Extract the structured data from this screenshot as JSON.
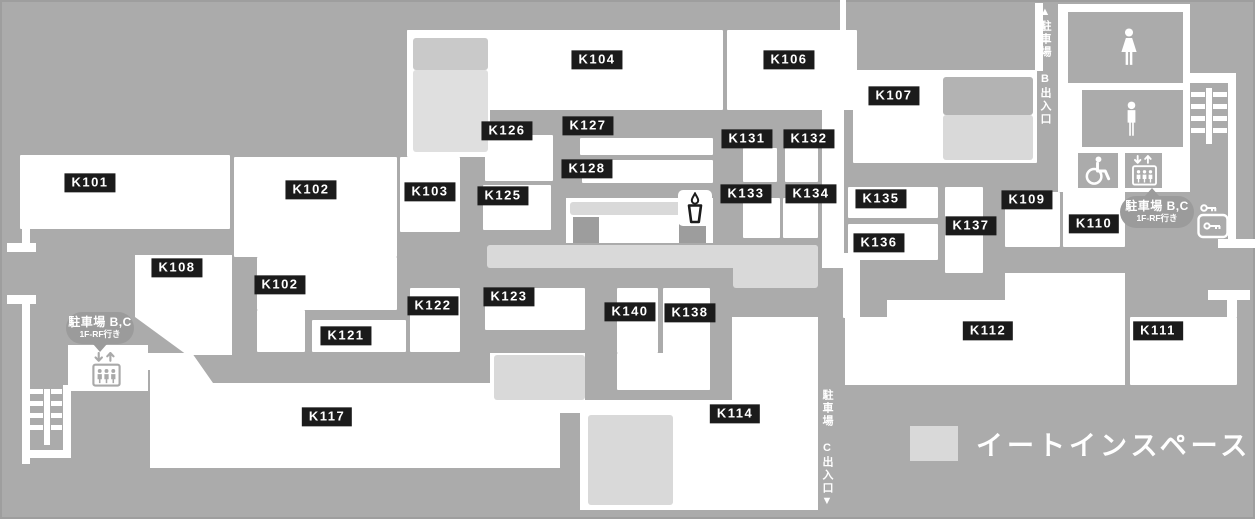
{
  "map": {
    "colors": {
      "background": "#ababab",
      "unit": "#ffffff",
      "eat_in": "#d9d9d9",
      "kiosk": "#9d9d9d",
      "label_bg": "#1b1b1b",
      "label_text": "#ffffff",
      "badge_bg": "#9b9b9b"
    },
    "legend": {
      "label": "イートインスペース",
      "swatch_color": "#d9d9d9"
    },
    "corridor_b": {
      "text": "▲駐車場 B出入口"
    },
    "corridor_c": {
      "text": "駐車場 C出入口▼"
    },
    "badges": {
      "left": {
        "line1": "駐車場 B,C",
        "line2": "1F-RF行き"
      },
      "right": {
        "line1": "駐車場 B,C",
        "line2": "1F-RF行き"
      }
    },
    "rooms": [
      {
        "id": "K101",
        "label": "K101",
        "label_cx": 90,
        "label_cy": 183,
        "rects": [
          [
            20,
            155,
            210,
            74
          ]
        ]
      },
      {
        "id": "K102",
        "label": "K102",
        "label_cx": 311,
        "label_cy": 190,
        "rects": [
          [
            234,
            157,
            163,
            100
          ]
        ]
      },
      {
        "id": "K102b",
        "label": "K102",
        "label_cx": 280,
        "label_cy": 285,
        "rects": [
          [
            257,
            257,
            140,
            53
          ],
          [
            257,
            310,
            48,
            42
          ]
        ]
      },
      {
        "id": "K103",
        "label": "K103",
        "label_cx": 430,
        "label_cy": 192,
        "rects": [
          [
            400,
            157,
            60,
            75
          ]
        ]
      },
      {
        "id": "K104",
        "label": "K104",
        "label_cx": 597,
        "label_cy": 60,
        "rects": [
          [
            407,
            30,
            316,
            80
          ],
          [
            407,
            30,
            83,
            127
          ]
        ]
      },
      {
        "id": "K106",
        "label": "K106",
        "label_cx": 789,
        "label_cy": 60,
        "rects": [
          [
            727,
            30,
            130,
            80
          ]
        ]
      },
      {
        "id": "K107",
        "label": "K107",
        "label_cx": 894,
        "label_cy": 96,
        "rects": [
          [
            853,
            70,
            184,
            93
          ]
        ]
      },
      {
        "id": "K108",
        "label": "K108",
        "label_cx": 177,
        "label_cy": 268,
        "polygon": [
          [
            135,
            255
          ],
          [
            232,
            255
          ],
          [
            232,
            355
          ],
          [
            187,
            355
          ],
          [
            135,
            317
          ]
        ]
      },
      {
        "id": "K109",
        "label": "K109",
        "label_cx": 1027,
        "label_cy": 200,
        "rects": [
          [
            1005,
            192,
            55,
            55
          ]
        ]
      },
      {
        "id": "K110",
        "label": "K110",
        "label_cx": 1094,
        "label_cy": 224,
        "rects": [
          [
            1063,
            190,
            62,
            57
          ]
        ]
      },
      {
        "id": "K111",
        "label": "K111",
        "label_cx": 1158,
        "label_cy": 331,
        "rects": [
          [
            1130,
            317,
            107,
            68
          ]
        ]
      },
      {
        "id": "K112",
        "label": "K112",
        "label_cx": 988,
        "label_cy": 331,
        "polygon": [
          [
            845,
            317
          ],
          [
            887,
            317
          ],
          [
            887,
            300
          ],
          [
            1005,
            300
          ],
          [
            1005,
            273
          ],
          [
            1125,
            273
          ],
          [
            1125,
            385
          ],
          [
            845,
            385
          ]
        ]
      },
      {
        "id": "K114",
        "label": "K114",
        "label_cx": 735,
        "label_cy": 414,
        "polygon": [
          [
            732,
            317
          ],
          [
            818,
            317
          ],
          [
            818,
            510
          ],
          [
            580,
            510
          ],
          [
            580,
            400
          ],
          [
            732,
            400
          ]
        ]
      },
      {
        "id": "K117",
        "label": "K117",
        "label_cx": 327,
        "label_cy": 417,
        "polygon": [
          [
            150,
            353
          ],
          [
            192,
            353
          ],
          [
            213,
            383
          ],
          [
            490,
            383
          ],
          [
            490,
            353
          ],
          [
            585,
            353
          ],
          [
            585,
            413
          ],
          [
            560,
            413
          ],
          [
            560,
            468
          ],
          [
            150,
            468
          ]
        ]
      },
      {
        "id": "K121",
        "label": "K121",
        "label_cx": 346,
        "label_cy": 336,
        "rects": [
          [
            312,
            320,
            94,
            32
          ]
        ]
      },
      {
        "id": "K122",
        "label": "K122",
        "label_cx": 433,
        "label_cy": 306,
        "rects": [
          [
            410,
            288,
            50,
            64
          ]
        ]
      },
      {
        "id": "K123",
        "label": "K123",
        "label_cx": 509,
        "label_cy": 297,
        "rects": [
          [
            485,
            288,
            100,
            42
          ]
        ]
      },
      {
        "id": "K125",
        "label": "K125",
        "label_cx": 503,
        "label_cy": 196,
        "rects": [
          [
            483,
            185,
            68,
            45
          ]
        ]
      },
      {
        "id": "K126",
        "label": "K126",
        "label_cx": 507,
        "label_cy": 131,
        "rects": [
          [
            485,
            135,
            68,
            46
          ]
        ]
      },
      {
        "id": "K127",
        "label": "K127",
        "label_cx": 588,
        "label_cy": 126,
        "rects": [
          [
            580,
            138,
            133,
            17
          ]
        ]
      },
      {
        "id": "K128",
        "label": "K128",
        "label_cx": 587,
        "label_cy": 169,
        "rects": [
          [
            582,
            160,
            131,
            23
          ]
        ]
      },
      {
        "id": "K131",
        "label": "K131",
        "label_cx": 747,
        "label_cy": 139,
        "rects": [
          [
            743,
            148,
            34,
            34
          ]
        ]
      },
      {
        "id": "K132",
        "label": "K132",
        "label_cx": 809,
        "label_cy": 139,
        "rects": [
          [
            785,
            148,
            33,
            34
          ]
        ]
      },
      {
        "id": "K133",
        "label": "K133",
        "label_cx": 746,
        "label_cy": 194,
        "rects": [
          [
            743,
            198,
            37,
            40
          ]
        ]
      },
      {
        "id": "K134",
        "label": "K134",
        "label_cx": 811,
        "label_cy": 194,
        "rects": [
          [
            783,
            198,
            35,
            40
          ]
        ]
      },
      {
        "id": "K135",
        "label": "K135",
        "label_cx": 881,
        "label_cy": 199,
        "rects": [
          [
            848,
            187,
            90,
            31
          ]
        ]
      },
      {
        "id": "K136",
        "label": "K136",
        "label_cx": 879,
        "label_cy": 243,
        "rects": [
          [
            848,
            224,
            90,
            36
          ],
          [
            843,
            253,
            17,
            65
          ]
        ]
      },
      {
        "id": "K137",
        "label": "K137",
        "label_cx": 971,
        "label_cy": 226,
        "rects": [
          [
            945,
            187,
            38,
            86
          ]
        ]
      },
      {
        "id": "K138",
        "label": "K138",
        "label_cx": 690,
        "label_cy": 313,
        "rects": [
          [
            663,
            288,
            47,
            102
          ]
        ]
      },
      {
        "id": "K140",
        "label": "K140",
        "label_cx": 630,
        "label_cy": 312,
        "rects": [
          [
            617,
            288,
            41,
            65
          ],
          [
            617,
            353,
            93,
            37
          ]
        ]
      }
    ],
    "walls": [
      [
        22,
        228,
        8,
        16
      ],
      [
        7,
        243,
        29,
        9
      ],
      [
        7,
        295,
        29,
        9
      ],
      [
        22,
        303,
        8,
        161
      ],
      [
        68,
        345,
        80,
        46
      ],
      [
        148,
        353,
        14,
        17
      ],
      [
        840,
        0,
        6,
        33
      ],
      [
        1035,
        3,
        8,
        68
      ],
      [
        1058,
        4,
        132,
        188
      ],
      [
        1183,
        73,
        53,
        10
      ],
      [
        1228,
        73,
        8,
        166
      ],
      [
        1218,
        239,
        37,
        9
      ],
      [
        1208,
        290,
        42,
        10
      ],
      [
        1227,
        300,
        10,
        17
      ],
      [
        822,
        110,
        22,
        158
      ],
      [
        566,
        198,
        147,
        45
      ],
      [
        63,
        385,
        8,
        73
      ],
      [
        28,
        450,
        43,
        8
      ],
      [
        44,
        389,
        6,
        56
      ],
      [
        28,
        389,
        15,
        5
      ],
      [
        28,
        401,
        15,
        5
      ],
      [
        28,
        413,
        15,
        5
      ],
      [
        28,
        425,
        15,
        5
      ],
      [
        51,
        389,
        11,
        5
      ],
      [
        51,
        401,
        11,
        5
      ],
      [
        51,
        413,
        11,
        5
      ],
      [
        51,
        425,
        11,
        5
      ],
      [
        1206,
        88,
        6,
        56
      ],
      [
        1191,
        92,
        14,
        5
      ],
      [
        1191,
        104,
        14,
        5
      ],
      [
        1191,
        116,
        14,
        5
      ],
      [
        1191,
        128,
        14,
        5
      ],
      [
        1213,
        92,
        14,
        5
      ],
      [
        1213,
        104,
        14,
        5
      ],
      [
        1213,
        116,
        14,
        5
      ],
      [
        1213,
        128,
        14,
        5
      ]
    ],
    "restroom_rooms": [
      [
        1068,
        12,
        115,
        71
      ],
      [
        1082,
        90,
        101,
        57
      ],
      [
        1078,
        153,
        40,
        35
      ],
      [
        1125,
        153,
        37,
        35
      ]
    ],
    "eat_in_areas": [
      {
        "rect": [
          413,
          38,
          75,
          32
        ],
        "color": "#c9c9c9"
      },
      {
        "rect": [
          413,
          70,
          75,
          82
        ],
        "color": "#dfdfdf"
      },
      {
        "rect": [
          943,
          77,
          90,
          38
        ],
        "color": "#b3b3b3"
      },
      {
        "rect": [
          943,
          115,
          90,
          45
        ],
        "color": "#d9d9d9"
      },
      {
        "rect": [
          570,
          202,
          139,
          13
        ],
        "color": "#d9d9d9"
      },
      {
        "rect": [
          487,
          245,
          331,
          23
        ],
        "color": "#d9d9d9"
      },
      {
        "rect": [
          733,
          245,
          85,
          43
        ],
        "color": "#d9d9d9"
      },
      {
        "rect": [
          494,
          355,
          91,
          45
        ],
        "color": "#d9d9d9"
      },
      {
        "rect": [
          588,
          415,
          85,
          90
        ],
        "color": "#d9d9d9"
      }
    ],
    "kiosks": [
      [
        573,
        217,
        26,
        26
      ],
      [
        679,
        222,
        27,
        21
      ]
    ],
    "facilities": [
      {
        "icon": "female-restroom-icon",
        "x": 1117,
        "y": 28,
        "w": 24,
        "h": 38,
        "color": "#ffffff"
      },
      {
        "icon": "male-restroom-icon",
        "x": 1121,
        "y": 100,
        "w": 21,
        "h": 38,
        "color": "#ffffff"
      },
      {
        "icon": "wheelchair-icon",
        "x": 1082,
        "y": 155,
        "w": 32,
        "h": 31,
        "color": "#ffffff"
      },
      {
        "icon": "elevator-icon",
        "x": 1130,
        "y": 155,
        "w": 29,
        "h": 31,
        "color": "#ffffff"
      },
      {
        "icon": "elevator-icon",
        "x": 90,
        "y": 352,
        "w": 33,
        "h": 35,
        "color": "#a9a9a9"
      },
      {
        "icon": "drink-cup-icon",
        "x": 678,
        "y": 190,
        "w": 30,
        "h": 32,
        "color": "#1c1c1c",
        "box": true
      },
      {
        "icon": "coin-locker-icon",
        "x": 1195,
        "y": 202,
        "w": 36,
        "h": 38,
        "color": "#ffffff"
      }
    ]
  }
}
